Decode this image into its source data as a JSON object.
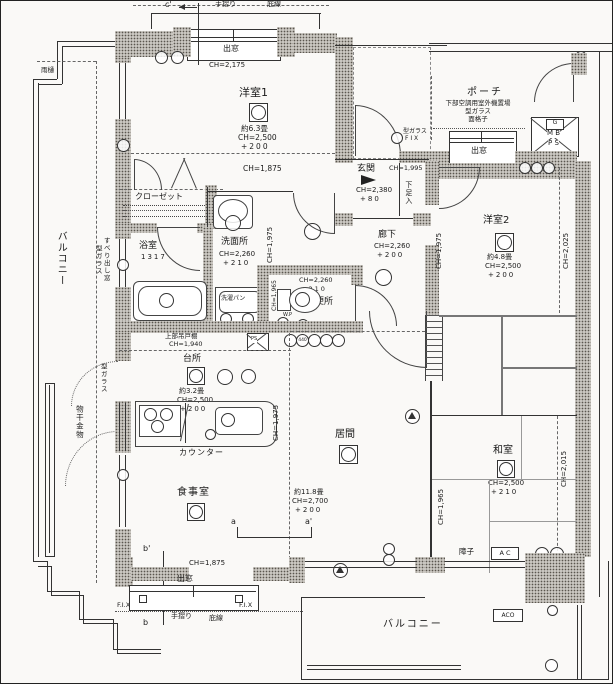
{
  "marks": {
    "a": "a",
    "a2": "a'",
    "b": "b",
    "b2": "b'",
    "c2": "c'"
  },
  "outdoor": {
    "balcony_left": "バルコニー",
    "balcony_bottom": "バルコニー",
    "monohoshi": "物干金物",
    "amadoi": "雨樋",
    "tesuri_top": "手摺り",
    "hisashi_top": "庇線",
    "tesuri_bottom": "手摺り",
    "hisashi_bottom": "庇線",
    "porch": "ポーチ",
    "porch_note1": "下部空調用室外機置場",
    "porch_note2": "型ガラス",
    "porch_note3": "面格子",
    "aco": "ACO",
    "ac": "A C",
    "shoji": "障子"
  },
  "windows": {
    "demado1": "出窓",
    "demado1_ch": "CH=2,175",
    "demado2": "出窓",
    "demado2_ch": "CH=1,875",
    "demado3": "出窓",
    "demado3_ch": "CH=1,875",
    "fix_v1": "型ガラス",
    "fix_v2": "F I X",
    "fix_l": "F.I.X",
    "fix_r": "F.I.X",
    "suberi1": "すべり出し窓",
    "suberi2": "型ガラス",
    "kata_v": "型ガラス"
  },
  "shaft": {
    "g": "G",
    "mb": "M B",
    "ps": "P S",
    "ps2": "PS",
    "r440": "440"
  },
  "rooms": {
    "y1": {
      "name": "洋室1",
      "area": "約6.3畳",
      "ch": "CH=2,500",
      "fl": "+200",
      "ch_low": "CH=1,875"
    },
    "closet": {
      "name": "クローゼット"
    },
    "genkan": {
      "name": "玄関",
      "ch_door": "CH=1,995",
      "ch": "CH=2,380",
      "fl": "+80",
      "shoe": "下足入"
    },
    "y2": {
      "name": "洋室2",
      "area": "約4.8畳",
      "ch": "CH=2,500",
      "fl": "+200",
      "ch_l": "CH=1,975",
      "ch_r": "CH=2,025"
    },
    "rouka": {
      "name": "廊下",
      "ch": "CH=2,260",
      "fl": "+200"
    },
    "senmen": {
      "name": "洗面所",
      "ch": "CH=2,260",
      "fl": "+210",
      "pan": "洗濯パン",
      "ch_side": "CH=1,975"
    },
    "yoku": {
      "name": "浴室",
      "size": "1317"
    },
    "benjo": {
      "name": "便所",
      "ch": "CH=2,260",
      "fl": "+210",
      "ch_s": "CH=1,965",
      "wp": "W.P"
    },
    "daidokoro": {
      "name": "台所",
      "area": "約3.2畳",
      "ch": "CH=2,500",
      "fl": "+200",
      "tana": "上部吊戸棚",
      "tana_ch": "CH=1,940",
      "counter": "カウンター",
      "ch_side": "CH=1,975"
    },
    "ima": {
      "name": "居間",
      "area": "約11.8畳",
      "ch": "CH=2,700",
      "fl": "+200"
    },
    "washitsu": {
      "name": "和室",
      "ch": "CH=2,500",
      "fl": "+210",
      "ch_l": "CH=1,965",
      "ch_r": "CH=2,015"
    },
    "shokuji": {
      "name": "食事室",
      "ch_low": "CH=1,875"
    }
  }
}
